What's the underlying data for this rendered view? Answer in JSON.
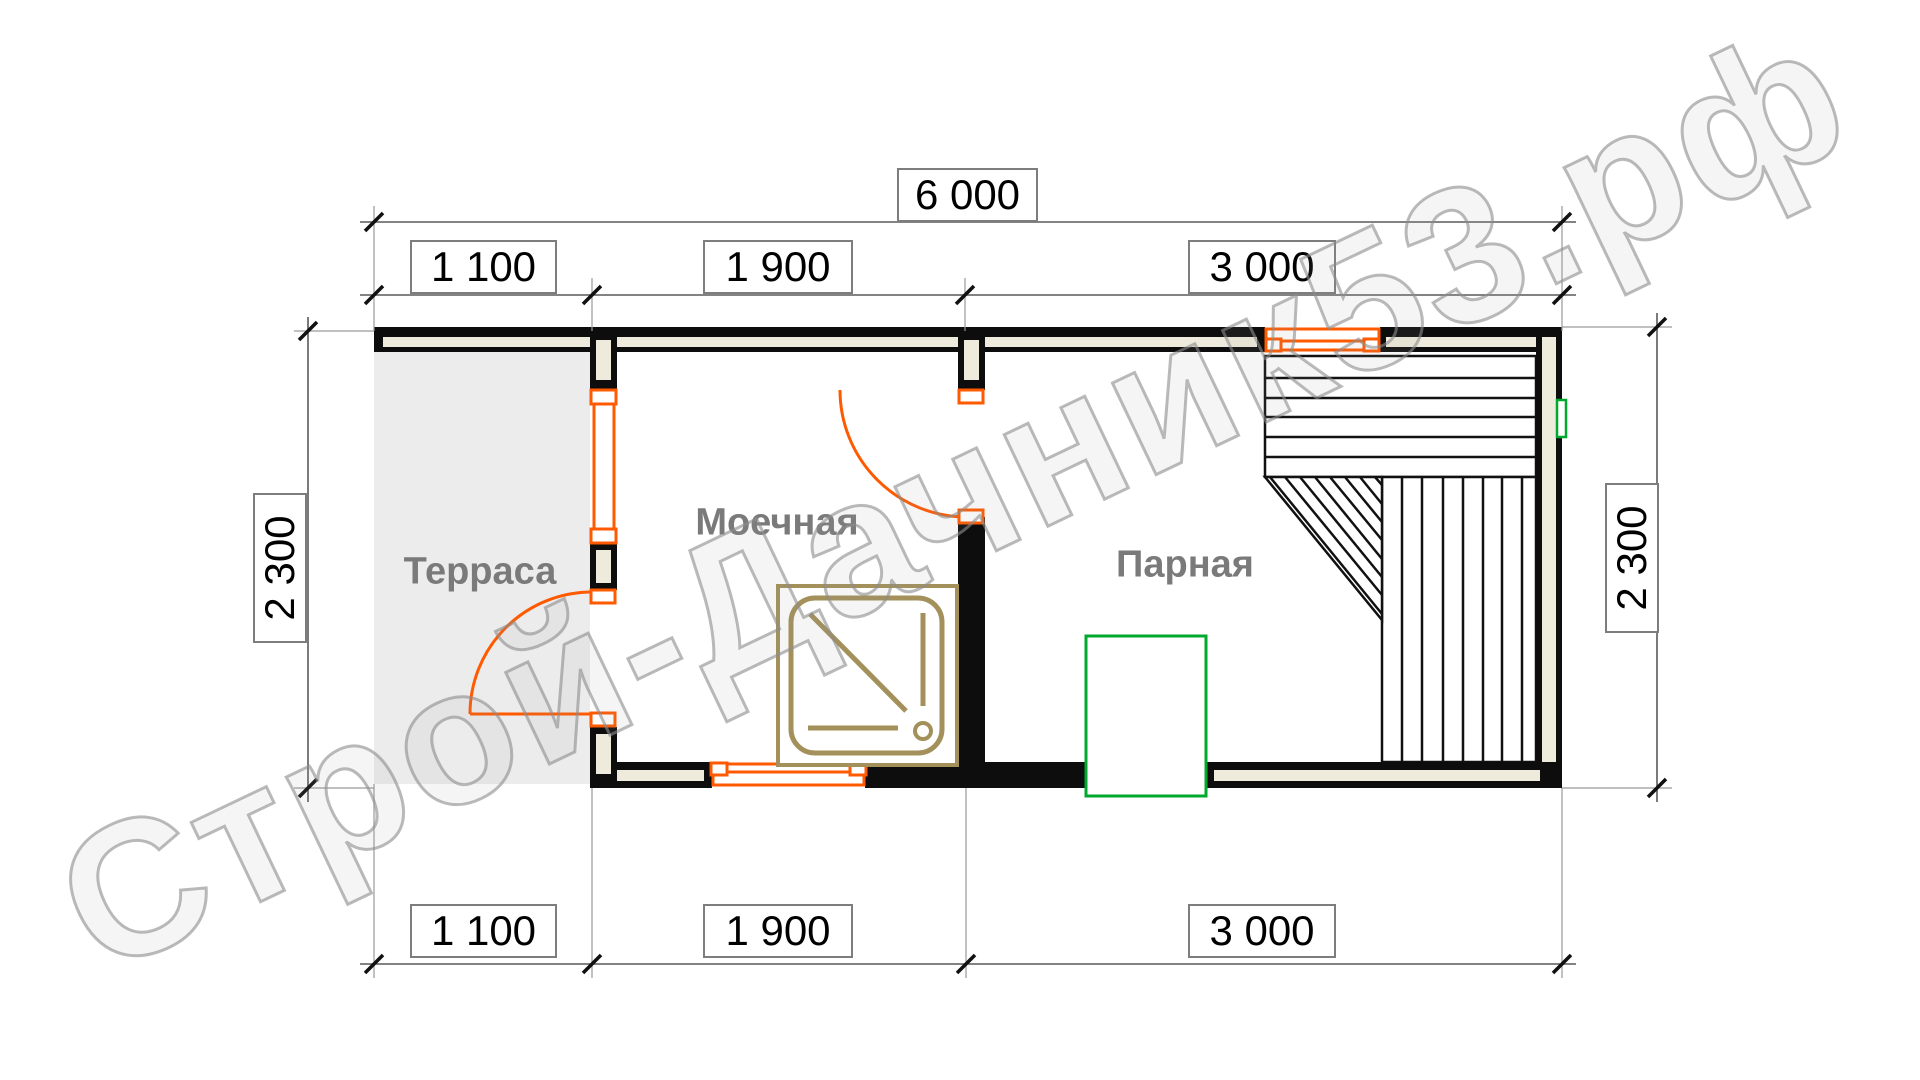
{
  "watermark": "Строй-Дачник53.рф",
  "dimensions": {
    "total_width": "6 000",
    "top_segments": [
      "1 100",
      "1 900",
      "3 000"
    ],
    "bottom_segments": [
      "1 100",
      "1 900",
      "3 000"
    ],
    "left_height": "2 300",
    "right_height": "2 300"
  },
  "rooms": {
    "terrace": "Терраса",
    "washroom": "Моечная",
    "steam_room": "Парная"
  },
  "fixtures": {
    "shower_tray_icon": "shower-tray-icon",
    "stove_icon": "stove-icon",
    "vent_icon": "vent-icon",
    "bench_icons": [
      "bench-top-icon",
      "bench-right-icon",
      "bench-corner-icon"
    ],
    "door_icons": [
      "door-arc-terrace-icon",
      "door-arc-steam-icon"
    ],
    "window_icons": [
      "window-partition-icon",
      "window-bottom-icon",
      "window-top-icon"
    ]
  },
  "colors": {
    "wall_black": "#0d0d0d",
    "wall_fill": "#efebdc",
    "terrace_fill": "#ececec",
    "opening_orange": "#ff5a00",
    "stove_green": "#00a92e",
    "shower_tan": "#a3905a",
    "room_label_gray": "#7a7a7a",
    "dim_line_gray": "#5a5a5a",
    "watermark_gray": "#8c8c8c"
  }
}
